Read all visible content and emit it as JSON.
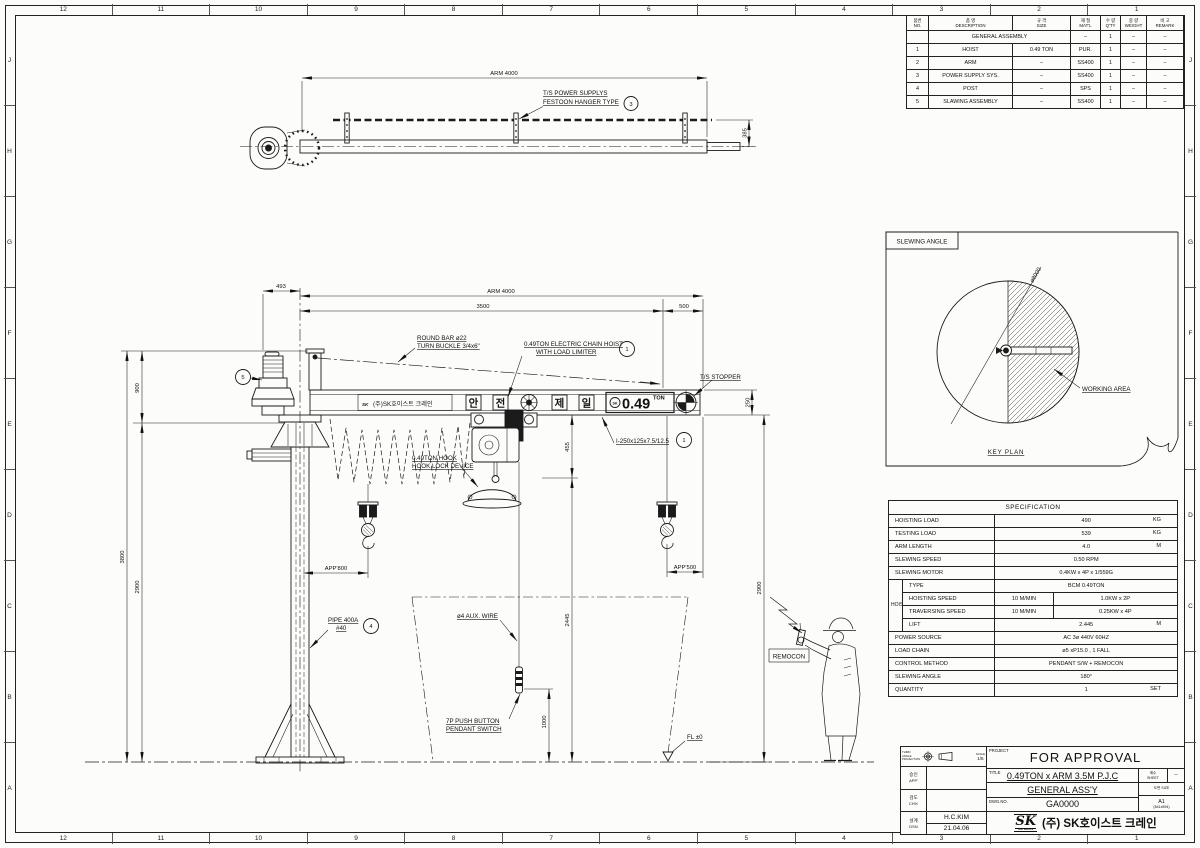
{
  "sheet": {
    "ruler_numbers": [
      "12",
      "11",
      "10",
      "9",
      "8",
      "7",
      "6",
      "5",
      "4",
      "3",
      "2",
      "1"
    ],
    "ruler_letters": [
      "J",
      "H",
      "G",
      "F",
      "E",
      "D",
      "C",
      "B",
      "A"
    ]
  },
  "plan_view": {
    "dim_arm": "ARM 4000",
    "dim_rail_offset": "385",
    "festoon_line1": "T/S POWER SUPPLYS",
    "festoon_line2": "FESTOON HANGER TYPE",
    "festoon_balloon_no": "3"
  },
  "elevation": {
    "dim_493": "493",
    "dim_arm": "ARM 4000",
    "dim_3500": "3500",
    "dim_500": "500",
    "dim_900": "900",
    "dim_3800": "3800",
    "dim_2900_left": "2900",
    "dim_250": "250",
    "dim_455": "455",
    "dim_2445": "2445",
    "dim_1000": "1000",
    "dim_2900_right": "2900",
    "dim_app_800": "APP'800",
    "dim_app_500": "APP'500",
    "label_round_bar_1": "ROUND BAR ø22",
    "label_round_bar_2": "TURN BUCKLE 3/4x6\"",
    "label_hoist_1": "0.49TON ELECTRIC CHAIN HOIST",
    "label_hoist_2": "WITH LOAD LIMITER",
    "balloon_hoist_no": "1",
    "label_ts_stopper": "T/S STOPPER",
    "label_beam_section": "I-250x125x7.5/12.5",
    "balloon_beam_no": "1",
    "label_hook_1": "0.49TON HOOK",
    "label_hook_2": "HOOK LOCK DEVICE",
    "label_pipe_1": "PIPE 400A",
    "label_pipe_2": "#40",
    "balloon_pipe_no": "4",
    "balloon_slew_no": "5",
    "label_aux_wire": "ø4 AUX. WIRE",
    "label_pendant_1": "7P PUSH BUTTON",
    "label_pendant_2": "PENDANT SWITCH",
    "label_fl": "FL ±0",
    "label_remocon": "REMOCON",
    "beam_brand": "(주)SK호이스트 크레인",
    "beam_logo": "SK",
    "beam_char_1": "안",
    "beam_char_2": "전",
    "beam_char_3": "제",
    "beam_char_4": "일",
    "beam_capacity": "0.49",
    "beam_capacity_unit": "TON"
  },
  "key_plan": {
    "panel_title": "SLEWING ANGLE",
    "diameter_label": "ø8000",
    "working_area_label": "WORKING AREA",
    "caption": "KEY PLAN"
  },
  "parts_table": {
    "headers": [
      {
        "ko": "품번",
        "en": "NO."
      },
      {
        "ko": "품 명",
        "en": "DESCRIPTION"
      },
      {
        "ko": "규 격",
        "en": "SIZE"
      },
      {
        "ko": "재 질",
        "en": "MAT'L"
      },
      {
        "ko": "수 량",
        "en": "Q'TY"
      },
      {
        "ko": "중 량",
        "en": "WEIGHT"
      },
      {
        "ko": "비 고",
        "en": "REMARK"
      }
    ],
    "rows": [
      {
        "no": "",
        "desc": "GENERAL ASSEMBLY",
        "size": "",
        "matl": "–",
        "qty": "1",
        "wt": "–",
        "rm": "–"
      },
      {
        "no": "1",
        "desc": "HOIST",
        "size": "0.49 TON",
        "matl": "PUR.",
        "qty": "1",
        "wt": "–",
        "rm": "–"
      },
      {
        "no": "2",
        "desc": "ARM",
        "size": "–",
        "matl": "SS400",
        "qty": "1",
        "wt": "–",
        "rm": "–"
      },
      {
        "no": "3",
        "desc": "POWER SUPPLY SYS.",
        "size": "–",
        "matl": "SS400",
        "qty": "1",
        "wt": "–",
        "rm": "–"
      },
      {
        "no": "4",
        "desc": "POST",
        "size": "–",
        "matl": "SPS",
        "qty": "1",
        "wt": "–",
        "rm": "–"
      },
      {
        "no": "5",
        "desc": "SLAWING ASSEMBLY",
        "size": "–",
        "matl": "SS400",
        "qty": "1",
        "wt": "–",
        "rm": "–"
      }
    ]
  },
  "specification": {
    "title": "SPECIFICATION",
    "hoisting_load": {
      "label": "HOISTING LOAD",
      "value": "490",
      "unit": "KG"
    },
    "testing_load": {
      "label": "TESTING LOAD",
      "value": "539",
      "unit": "KG"
    },
    "arm_length": {
      "label": "ARM LENGTH",
      "value": "4.0",
      "unit": "M"
    },
    "slewing_speed": {
      "label": "SLEWING SPEED",
      "value": "0.50 RPM"
    },
    "slewing_motor": {
      "label": "SLEWING MOTOR",
      "value": "0.4KW x 4P x 1/559G"
    },
    "hoist_group": "HOIST",
    "type": {
      "label": "TYPE",
      "value": "BCM 0.49TON"
    },
    "hoisting_speed": {
      "label": "HOISTING SPEED",
      "v1": "10 M/MIN",
      "v2": "1.0KW x 2P"
    },
    "traversing_speed": {
      "label": "TRAVERSING SPEED",
      "v1": "10 M/MIN",
      "v2": "0.25KW x 4P"
    },
    "lift": {
      "label": "LIFT",
      "value": "2.445",
      "unit": "M"
    },
    "power_source": {
      "label": "POWER SOURCE",
      "value": "AC 3ø 440V 60HZ"
    },
    "load_chain": {
      "label": "LOAD CHAIN",
      "value": "ø5 xP15.0 , 1 FALL"
    },
    "control_method": {
      "label": "CONTROL METHOD",
      "value": "PENDANT S/W + REMOCON"
    },
    "slewing_angle": {
      "label": "SLEWING ANGLE",
      "value": "180°"
    },
    "quantity": {
      "label": "QUANTITY",
      "value": "1",
      "unit": "SET"
    }
  },
  "title_block": {
    "projection_label": "THIRD ANGLE PROJECTION",
    "scale_label": "SCALE",
    "scale_value": "1/5",
    "approve_ko": "승인",
    "approve_en": "APP'",
    "check_ko": "검도",
    "check_en": "CH'K",
    "design_ko": "설계",
    "design_en": "DSN",
    "designer": "H.C.KIM",
    "date": "21.04.06",
    "project_label": "PROJECT",
    "project_value": "FOR APPROVAL",
    "title_label": "TITLE",
    "title_line1": "0.49TON x ARM 3.5M P.J.C",
    "title_line2": "GENERAL ASS'Y",
    "dwg_label": "DWG.NO.",
    "dwg_value": "GA0000",
    "sheet_ko": "매수",
    "sheet_en": "SHEET",
    "sheet_value": "–",
    "size_label": "도면 SIZE",
    "size_value1": "A1",
    "size_value2": "(841x594)",
    "logo_text": "SK",
    "logo_sub": "S.K HOIST",
    "company": "(주) SK호이스트 크레인"
  }
}
